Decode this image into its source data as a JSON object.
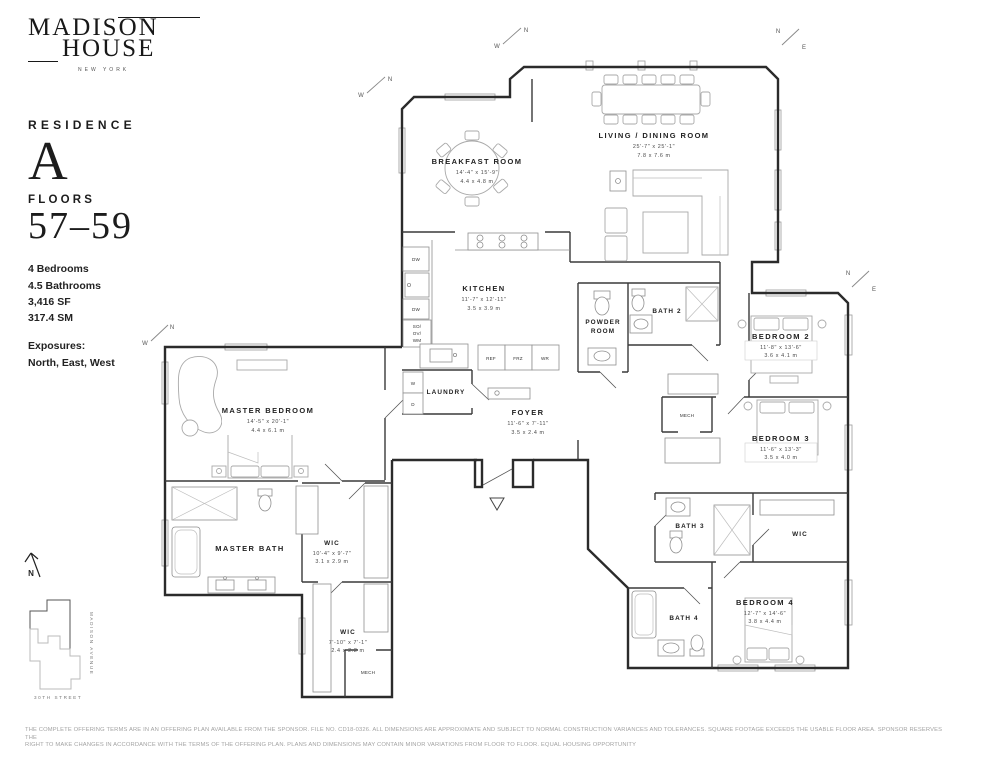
{
  "brand": {
    "line1": "MADISON",
    "line2": "HOUSE",
    "city": "NEW YORK"
  },
  "residence": {
    "label": "RESIDENCE",
    "letter": "A",
    "floors_label": "FLOORS",
    "floors_range": "57–59",
    "specs": [
      "4 Bedrooms",
      "4.5 Bathrooms",
      "3,416 SF",
      "317.4 SM"
    ],
    "exposures_label": "Exposures:",
    "exposures_value": "North, East, West"
  },
  "rooms": {
    "living": {
      "name": "LIVING / DINING ROOM",
      "dims_ft": "25'-7\" x 25'-1\"",
      "dims_m": "7.8 x 7.6 m"
    },
    "breakfast": {
      "name": "BREAKFAST ROOM",
      "dims_ft": "14'-4\" x 15'-9\"",
      "dims_m": "4.4 x 4.8 m"
    },
    "kitchen": {
      "name": "KITCHEN",
      "dims_ft": "11'-7\" x 12'-11\"",
      "dims_m": "3.5 x 3.9 m"
    },
    "foyer": {
      "name": "FOYER",
      "dims_ft": "11'-6\" x 7'-11\"",
      "dims_m": "3.5 x 2.4 m"
    },
    "laundry": {
      "name": "LAUNDRY"
    },
    "powder": {
      "line1": "POWDER",
      "line2": "ROOM"
    },
    "bath2": {
      "name": "BATH 2"
    },
    "bedroom2": {
      "name": "BEDROOM 2",
      "dims_ft": "11'-8\" x 13'-6\"",
      "dims_m": "3.6 x 4.1 m"
    },
    "mech_hall": {
      "name": "MECH"
    },
    "bedroom3": {
      "name": "BEDROOM 3",
      "dims_ft": "11'-6\" x 13'-3\"",
      "dims_m": "3.5 x 4.0 m"
    },
    "master_bedroom": {
      "name": "MASTER BEDROOM",
      "dims_ft": "14'-5\" x 20'-1\"",
      "dims_m": "4.4 x 6.1 m"
    },
    "master_bath": {
      "name": "MASTER BATH"
    },
    "wic_master": {
      "name": "WIC",
      "dims_ft": "10'-4\" x 9'-7\"",
      "dims_m": "3.1 x 2.9 m"
    },
    "wic2": {
      "name": "WIC",
      "dims_ft": "7'-10\" x 7'-1\"",
      "dims_m": "2.4 x 2.2 m"
    },
    "mech_closet": {
      "name": "MECH"
    },
    "bath3": {
      "name": "BATH 3"
    },
    "wic_bedroom4": {
      "name": "WIC"
    },
    "bath4": {
      "name": "BATH 4"
    },
    "bedroom4": {
      "name": "BEDROOM 4",
      "dims_ft": "12'-7\" x 14'-6\"",
      "dims_m": "3.8 x 4.4 m"
    }
  },
  "appliances": {
    "dw": "DW",
    "so1": "SO/",
    "so2": "OV/",
    "so3": "WM",
    "ref": "REF",
    "frz": "FRZ",
    "wr": "WR",
    "washer": "W",
    "dryer": "D"
  },
  "compass": {
    "n": "N",
    "e": "E",
    "w": "W"
  },
  "keyplan": {
    "north": "N",
    "avenue": "MADISON AVENUE",
    "street": "30TH STREET"
  },
  "disclaimer": {
    "line1": "THE COMPLETE OFFERING TERMS ARE IN AN OFFERING PLAN AVAILABLE FROM THE SPONSOR. FILE NO. CD18-0326. ALL DIMENSIONS ARE APPROXIMATE AND SUBJECT TO NORMAL CONSTRUCTION VARIANCES AND TOLERANCES. SQUARE FOOTAGE EXCEEDS THE USABLE FLOOR AREA. SPONSOR RESERVES THE",
    "line2": "RIGHT TO MAKE CHANGES IN ACCORDANCE WITH THE TERMS OF THE OFFERING PLAN. PLANS AND DIMENSIONS MAY CONTAIN MINOR VARIATIONS FROM FLOOR TO FLOOR.  EQUAL HOUSING OPPORTUNITY"
  }
}
